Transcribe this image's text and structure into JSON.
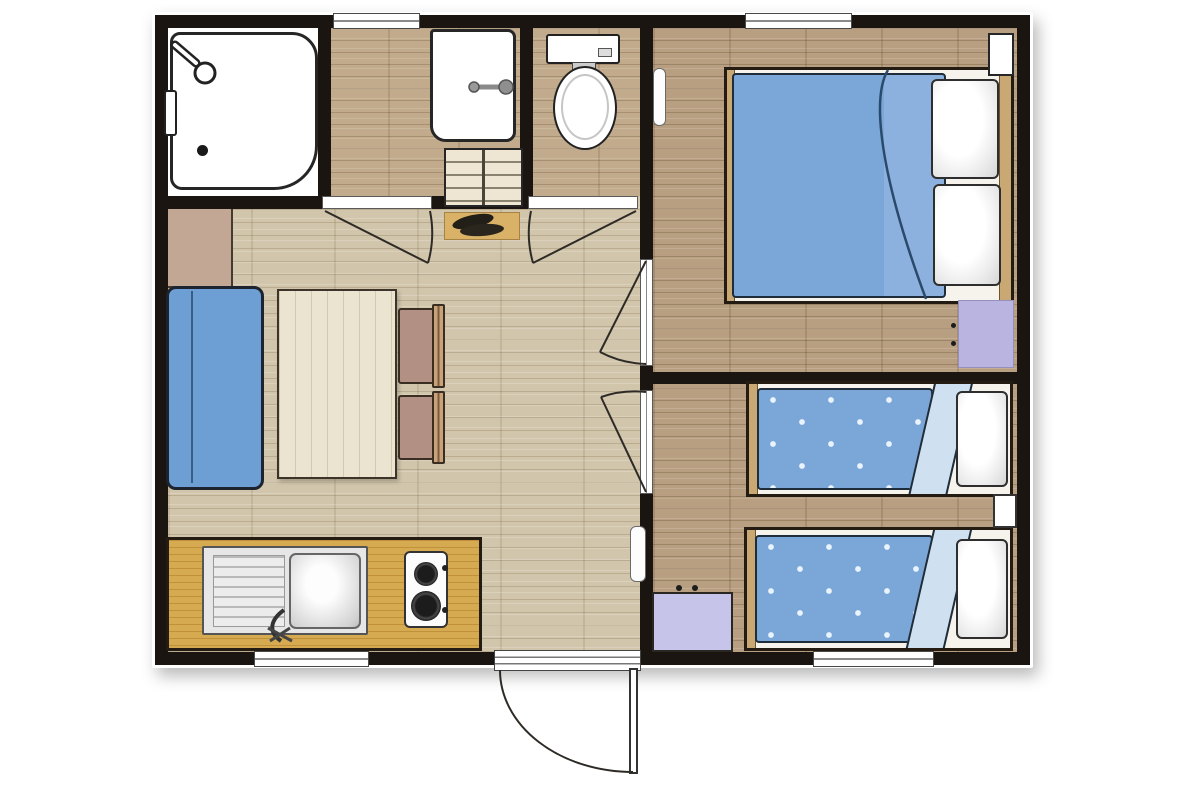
{
  "floor_plan": {
    "type": "floor-plan",
    "description": "Top-down 2D floor plan of a two-bedroom holiday chalet / mobile home. No text labels are rendered in the drawing.",
    "rooms": [
      {
        "id": "shower-room",
        "fixtures": [
          "shower-tray",
          "shower-head",
          "shower-controls",
          "shower-drain"
        ]
      },
      {
        "id": "washroom",
        "fixtures": [
          "washbasin",
          "washbasin-faucet",
          "storage-shelf-unit",
          "doormat",
          "shoes"
        ]
      },
      {
        "id": "wc",
        "fixtures": [
          "toilet-cistern",
          "toilet-flush-button",
          "toilet-bowl"
        ]
      },
      {
        "id": "living-kitchen",
        "fixtures": [
          "sideboard",
          "sofa",
          "dining-table",
          "dining-chair",
          "dining-chair",
          "kitchen-counter",
          "kitchen-sink",
          "sink-drainboard",
          "sink-faucet",
          "hob-2-burner",
          "radiator"
        ]
      },
      {
        "id": "bedroom-double",
        "fixtures": [
          "double-bed",
          "duvet",
          "pillow",
          "pillow",
          "nightstand",
          "wall-cabinet",
          "radiator"
        ]
      },
      {
        "id": "bedroom-twin",
        "fixtures": [
          "single-bed",
          "single-bed",
          "duvet",
          "duvet",
          "pillow",
          "pillow",
          "nightstand",
          "dresser"
        ]
      }
    ],
    "openings": {
      "windows": 4,
      "interior_doors": 4,
      "entrance_doors": 1
    },
    "colors": {
      "wall": "#1a1511",
      "line_dark": "#2e2a26",
      "floor_living": "#d1c5ab",
      "floor_bedroom": "#b89f81",
      "floor_bath": "#c1ab8c",
      "sofa_blue": "#6e9fd4",
      "duvet_blue": "#7aa6d8",
      "duvet_fold": "#cfe0f1",
      "lavender": "#b9b5e0",
      "lavender_light": "#c7c4ea",
      "counter": "#d6aa50",
      "wood_trim": "#c9a873",
      "cabinet_tan": "#c3a795",
      "table": "#eae4d1",
      "chair_seat": "#b29083",
      "chair_wood": "#c9a276",
      "mat": "#d9b267"
    }
  }
}
